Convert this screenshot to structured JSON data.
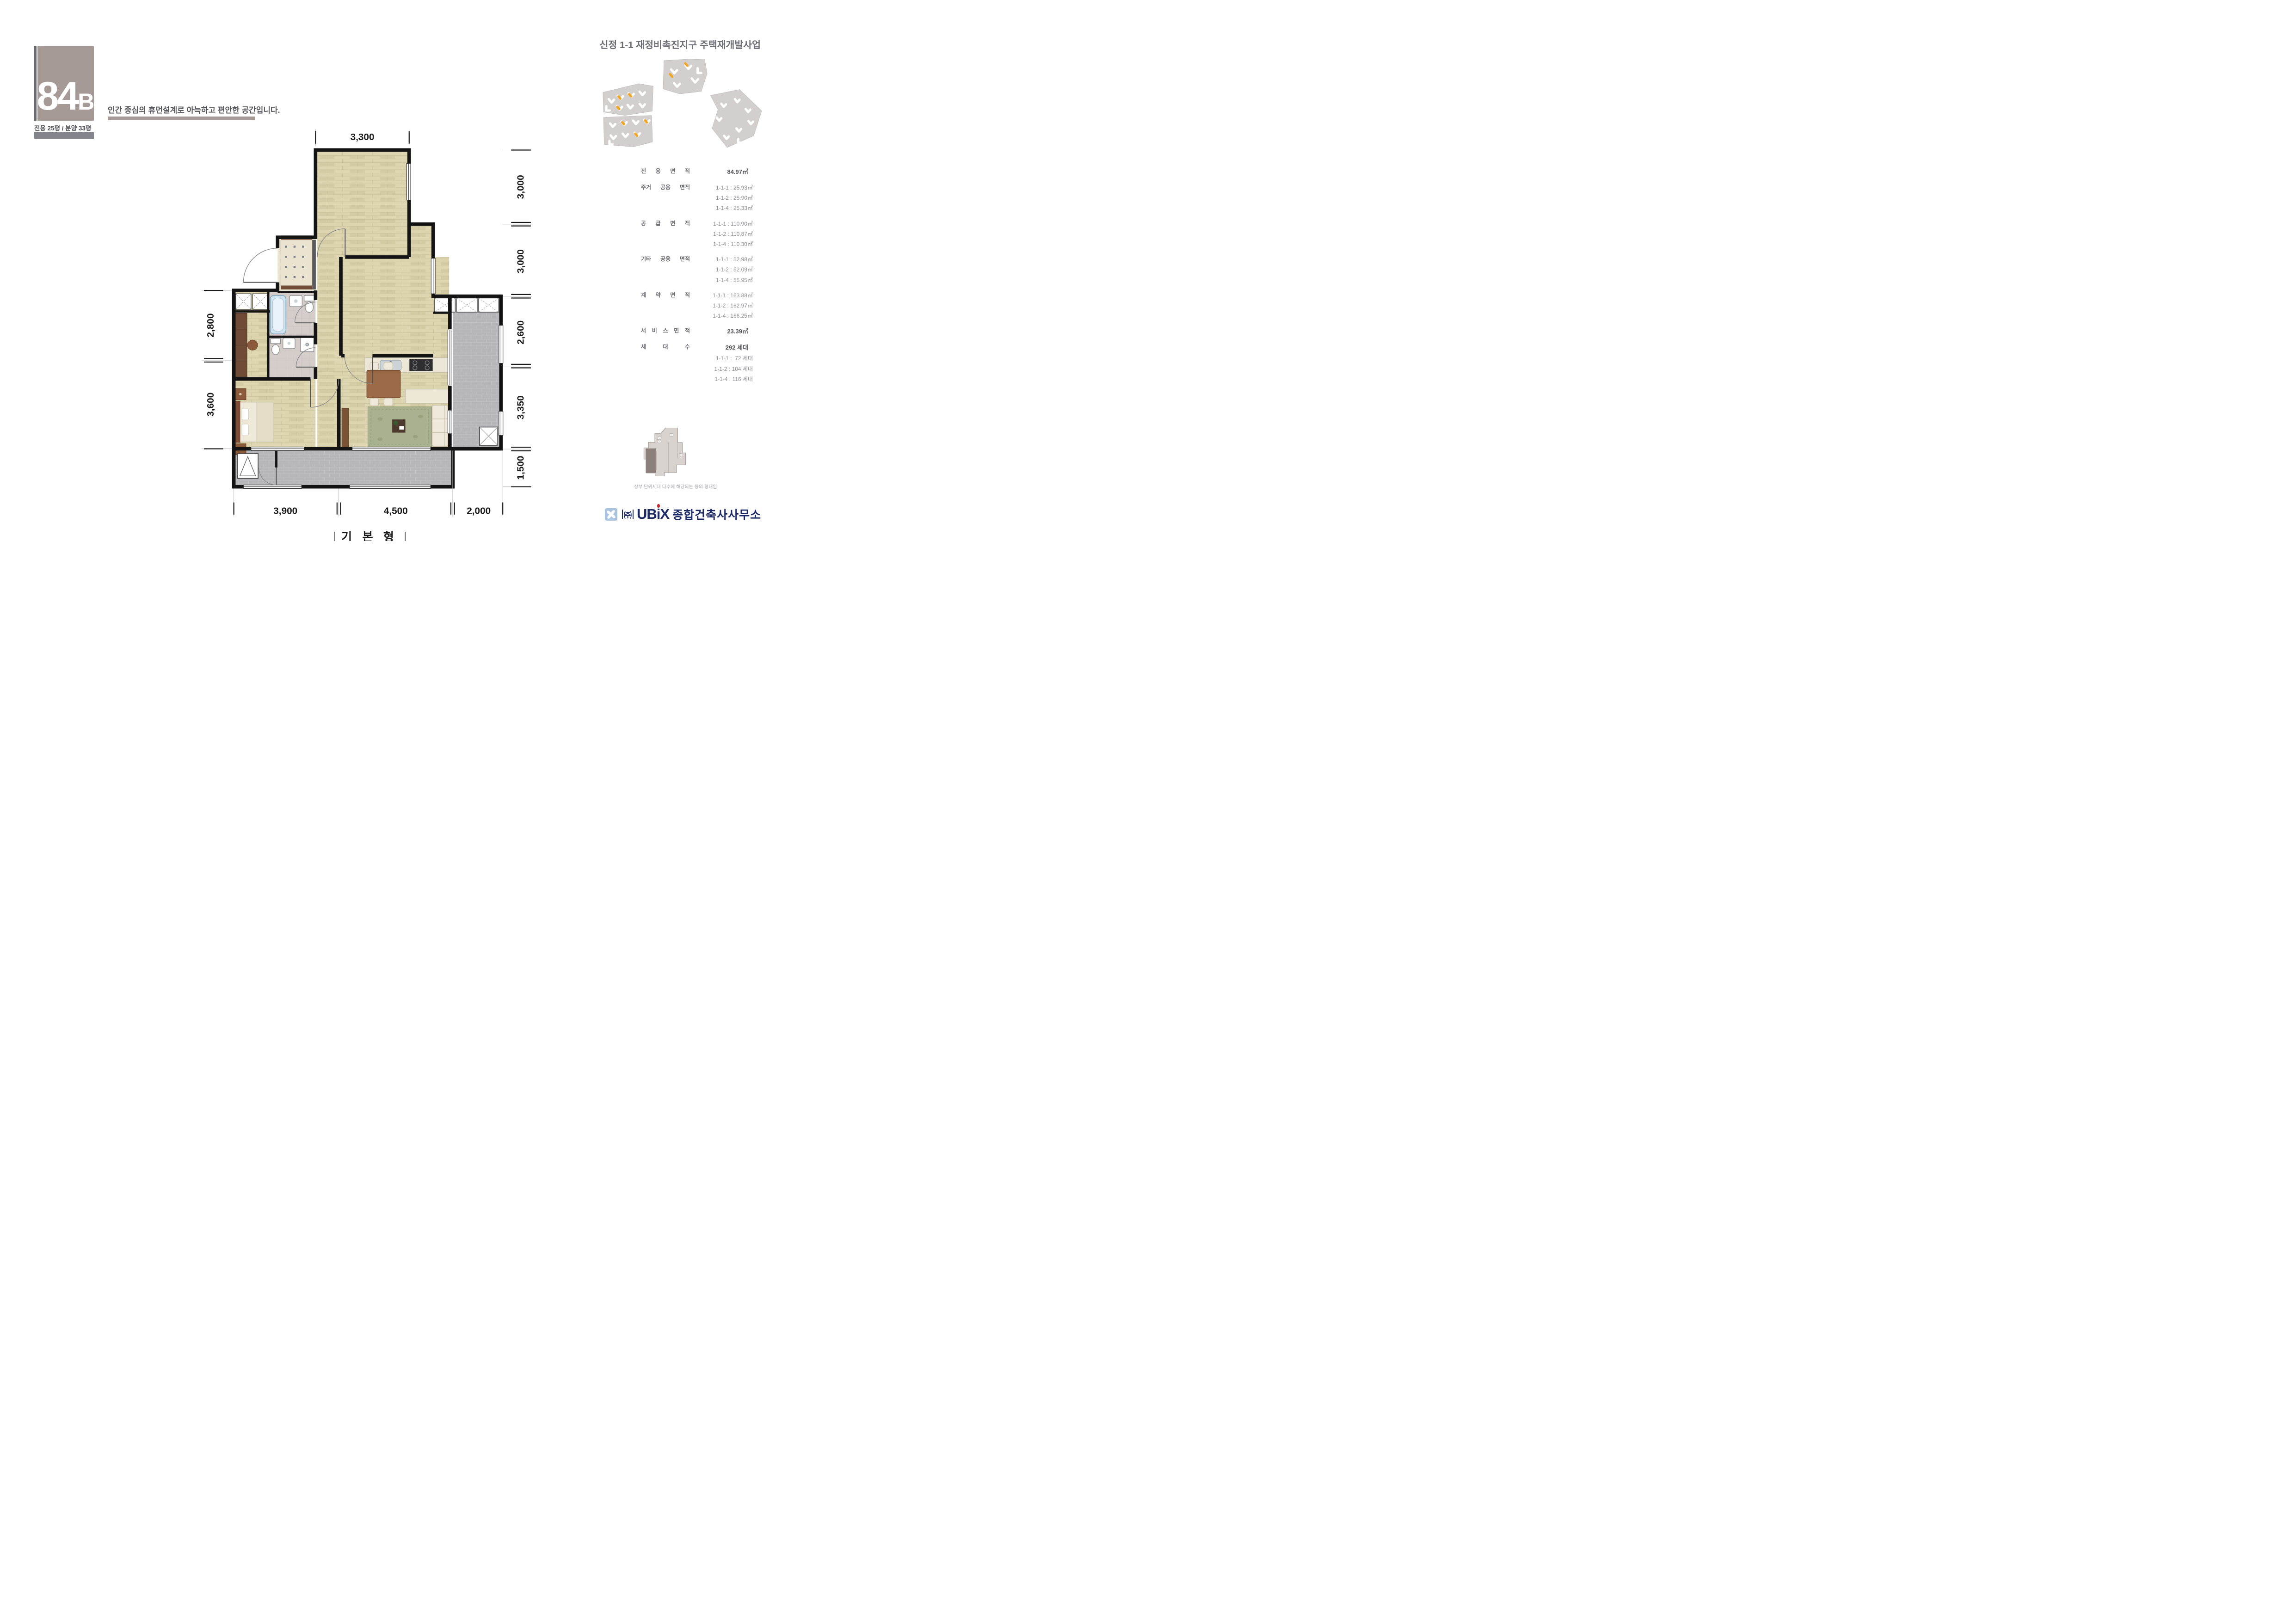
{
  "unit_badge": {
    "number": "84",
    "letter": "B",
    "spec": "전용 25평 / 분양 33평"
  },
  "tagline": "인간 중심의 휴먼설계로 아늑하고 편안한 공간입니다.",
  "project_title": "신정 1-1 재정비촉진지구 주택재개발사업",
  "area_table": {
    "rows": [
      {
        "label": "전 용 면 적",
        "v0": "84.97㎡"
      },
      {
        "label": "주거 공용 면적",
        "v0": "1-1-1 : 25.93㎡",
        "v1": "1-1-2 : 25.90㎡",
        "v2": "1-1-4 : 25.33㎡"
      },
      {
        "label": "공 급 면 적",
        "v0": "1-1-1 : 110.90㎡",
        "v1": "1-1-2 : 110.87㎡",
        "v2": "1-1-4 : 110.30㎡"
      },
      {
        "label": "기타 공용 면적",
        "v0": "1-1-1 : 52.98㎡",
        "v1": "1-1-2 : 52.09㎡",
        "v2": "1-1-4 : 55.95㎡"
      },
      {
        "label": "계 약 면 적",
        "v0": "1-1-1 : 163.88㎡",
        "v1": "1-1-2 : 162.97㎡",
        "v2": "1-1-4 : 166.25㎡"
      },
      {
        "label": "서 비 스 면 적",
        "v0": "23.39㎡"
      },
      {
        "label": "세  대  수",
        "v0": "292 세대",
        "v1": "1-1-1 :  72 세대",
        "v2": "1-1-2 : 104 세대",
        "v3": "1-1-4 : 116 세대"
      }
    ]
  },
  "floor_plan": {
    "caption": "기 본 형",
    "dims": {
      "top": "3,300",
      "right": [
        "3,000",
        "3,000",
        "2,600",
        "3,350",
        "1,500"
      ],
      "left": [
        "2,800",
        "3,600"
      ],
      "bottom": [
        "3,900",
        "4,500",
        "2,000"
      ]
    }
  },
  "site_note": "상부 단위세대 다수에 해당되는 동의 형태임",
  "logo": {
    "company_prefix": "㈜",
    "brand_ub": "UB",
    "brand_i": "i",
    "brand_x": "X",
    "brand_suffix": "종합건축사사무소"
  },
  "colors": {
    "accent_taupe": "#a69a97",
    "bar_gray": "#84848c",
    "navy": "#1d2a68",
    "logo_red": "#c8232b",
    "highlight_orange": "#f2a51e",
    "wall_black": "#141414"
  }
}
